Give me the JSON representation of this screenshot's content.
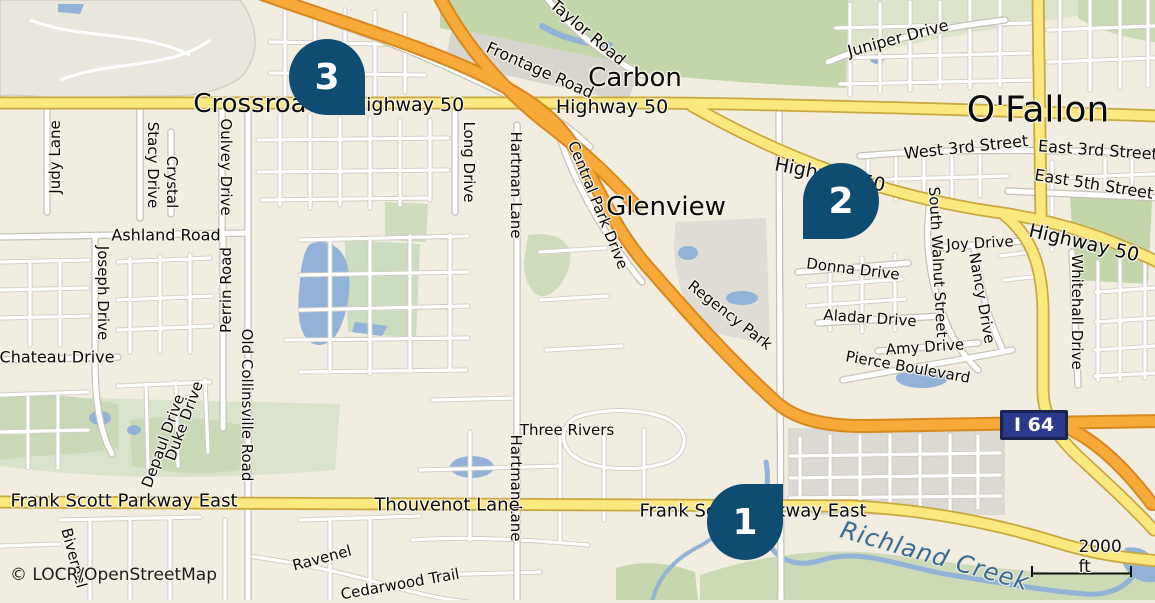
{
  "attribution": "© LOCR/OpenStreetMap",
  "scale": {
    "label": "2000 ft"
  },
  "shield": {
    "text": "I 64"
  },
  "towns": [
    {
      "name": "Crossroads"
    },
    {
      "name": "Carbon"
    },
    {
      "name": "Glenview"
    },
    {
      "name": "O'Fallon"
    }
  ],
  "road_labels": [
    {
      "text": "Highway 50"
    },
    {
      "text": "Highway 50"
    },
    {
      "text": "Highway 50"
    },
    {
      "text": "Highway 50"
    },
    {
      "text": "Frontage Road"
    },
    {
      "text": "Taylor Road"
    },
    {
      "text": "Juniper Drive"
    },
    {
      "text": "West 3rd Street"
    },
    {
      "text": "East 3rd Street"
    },
    {
      "text": "East 5th Street"
    },
    {
      "text": "Judy Lane"
    },
    {
      "text": "Stacy Drive"
    },
    {
      "text": "Crystal"
    },
    {
      "text": "Oulvey Drive"
    },
    {
      "text": "Long Drive"
    },
    {
      "text": "Hartman Lane"
    },
    {
      "text": "Hartman Lane"
    },
    {
      "text": "Central Park Drive"
    },
    {
      "text": "Ashland Road"
    },
    {
      "text": "Joseph Drive"
    },
    {
      "text": "Perrin Road"
    },
    {
      "text": "Old Collinsville Road"
    },
    {
      "text": "Chateau Drive"
    },
    {
      "text": "Depaul Drive"
    },
    {
      "text": "Duke Drive"
    },
    {
      "text": "Bivernel"
    },
    {
      "text": "Three Rivers"
    },
    {
      "text": "Thouvenot Lane"
    },
    {
      "text": "Frank Scott Parkway East"
    },
    {
      "text": "Frank Scott Parkway East"
    },
    {
      "text": "Ravenel"
    },
    {
      "text": "Cedarwood Trail"
    },
    {
      "text": "Donna Drive"
    },
    {
      "text": "Joy Drive"
    },
    {
      "text": "Aladar Drive"
    },
    {
      "text": "Amy Drive"
    },
    {
      "text": "Pierce Boulevard"
    },
    {
      "text": "South Walnut Street"
    },
    {
      "text": "Nancy Drive"
    },
    {
      "text": "Whitehall Drive"
    },
    {
      "text": "Regency Park"
    }
  ],
  "water_labels": [
    {
      "text": "Richland Creek"
    }
  ],
  "markers": [
    {
      "number": "1"
    },
    {
      "number": "2"
    },
    {
      "number": "3"
    }
  ],
  "colors": {
    "marker": "#0f4c72",
    "motorway": "#f7a93a",
    "highway": "#fbe87e",
    "water": "#92b2d8",
    "shield_bg": "#2b3a8c",
    "park_green": "#c2d6aa",
    "background": "#f1ede0"
  }
}
